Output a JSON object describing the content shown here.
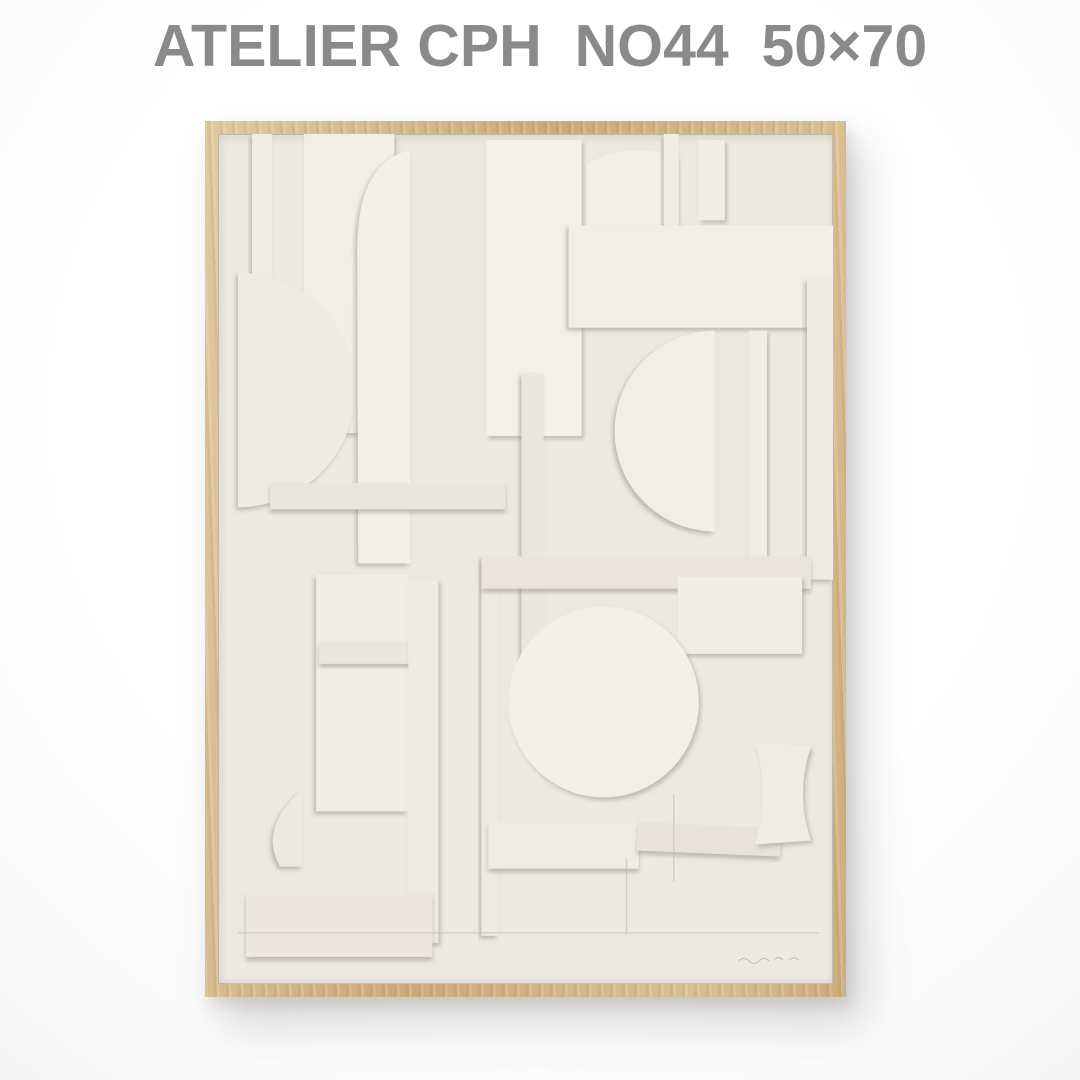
{
  "header": {
    "title": "ATELIER CPH  NO44  50×70",
    "brand": "ATELIER CPH",
    "item_no": "NO44",
    "size": "50×70",
    "text_color": "#8a8a8a"
  },
  "poster": {
    "frame_wood_color": "#cfae7e",
    "paper_color": "#ECE9E2",
    "shadow_color": "#968f81",
    "artwork": {
      "type": "paper-relief-collage",
      "pieces": [
        {
          "kind": "rect",
          "x": 34,
          "y": 0,
          "w": 20,
          "h": 200,
          "fill": "#EFECE5",
          "sh": "l"
        },
        {
          "kind": "rect",
          "x": 86,
          "y": 0,
          "w": 90,
          "h": 298,
          "fill": "#F0EEE7",
          "sh": "r"
        },
        {
          "kind": "path",
          "d": "M20 138 A117 117 0 0 1 20 372 Z",
          "fill": "#EDEBE4",
          "sh": "l"
        },
        {
          "kind": "path",
          "d": "M192 16 Q138 28 139 118 L140 428 L192 428 Z",
          "fill": "#F1EFE8",
          "sh": "l"
        },
        {
          "kind": "rect",
          "x": 268,
          "y": 6,
          "w": 95,
          "h": 295,
          "fill": "#F2F0E9",
          "sh": "r"
        },
        {
          "kind": "rect",
          "x": 303,
          "y": 238,
          "w": 22,
          "h": 300,
          "fill": "#EAE7DF",
          "sh": "l"
        },
        {
          "kind": "path",
          "d": "M368 101 L368 30 Q412 6 458 23 L458 101 Z",
          "fill": "#F1EFE9",
          "sh": "r"
        },
        {
          "kind": "rect",
          "x": 445,
          "y": 0,
          "w": 15,
          "h": 176,
          "fill": "#EFEDE6",
          "sh": "l"
        },
        {
          "kind": "rect",
          "x": 480,
          "y": 6,
          "w": 26,
          "h": 80,
          "fill": "#EFEDE6",
          "sh": "r"
        },
        {
          "kind": "rect",
          "x": 350,
          "y": 91,
          "w": 268,
          "h": 102,
          "fill": "#F0EEE7",
          "sh": "l"
        },
        {
          "kind": "path",
          "d": "M496 196 A100 100 0 0 0 496 396 Z",
          "fill": "#F0EEE7",
          "sh": "l"
        },
        {
          "kind": "rect",
          "x": 530,
          "y": 196,
          "w": 18,
          "h": 230,
          "fill": "#EFECE5",
          "sh": "r"
        },
        {
          "kind": "rect",
          "x": 588,
          "y": 144,
          "w": 26,
          "h": 300,
          "fill": "#EEEBE4",
          "sh": "l"
        },
        {
          "kind": "rect",
          "x": 52,
          "y": 348,
          "w": 235,
          "h": 26,
          "fill": "#E9E6DD",
          "sh": "d"
        },
        {
          "kind": "rect",
          "x": 263,
          "y": 421,
          "w": 17,
          "h": 378,
          "fill": "#EDEAE2",
          "sh": "l"
        },
        {
          "kind": "rect",
          "x": 263,
          "y": 421,
          "w": 329,
          "h": 32,
          "fill": "#E9E5DA",
          "sh": "d"
        },
        {
          "kind": "rect",
          "x": 459,
          "y": 441,
          "w": 124,
          "h": 77,
          "fill": "#F0EDE6",
          "sh": "r"
        },
        {
          "kind": "circle",
          "cx": 385,
          "cy": 566,
          "r": 95,
          "fill": "#F1EFE8",
          "sh": "r"
        },
        {
          "kind": "rect",
          "x": 98,
          "y": 439,
          "w": 92,
          "h": 236,
          "fill": "#F0EDE6",
          "sh": "l"
        },
        {
          "kind": "rect",
          "x": 101,
          "y": 506,
          "w": 102,
          "h": 22,
          "fill": "#E9E6DD",
          "sh": "d"
        },
        {
          "kind": "rect",
          "x": 190,
          "y": 444,
          "w": 30,
          "h": 362,
          "fill": "#EEEBE4",
          "sh": "r"
        },
        {
          "kind": "path",
          "d": "M84 653 Q40 692 62 730 L84 730 Z",
          "fill": "#ECE9E2",
          "sh": "l"
        },
        {
          "kind": "rect",
          "x": 28,
          "y": 756,
          "w": 186,
          "h": 64,
          "fill": "#ECE8DF",
          "sh": "d"
        },
        {
          "kind": "rect",
          "x": 270,
          "y": 686,
          "w": 150,
          "h": 46,
          "fill": "#EFECE4",
          "sh": "d"
        },
        {
          "kind": "path",
          "d": "M420 686 L563 692 L561 720 L418 714 Z",
          "fill": "#E7E3D8",
          "sh": "d"
        },
        {
          "kind": "path",
          "d": "M536 606 L592 610 Q576 658 592 704 L536 708 Q552 657 536 606 Z",
          "fill": "#EFECE5",
          "sh": "r"
        }
      ],
      "faint_lines": [
        {
          "x1": 20,
          "y1": 796,
          "x2": 600,
          "y2": 796
        },
        {
          "x1": 408,
          "y1": 722,
          "x2": 408,
          "y2": 798
        },
        {
          "x1": 455,
          "y1": 658,
          "x2": 455,
          "y2": 745
        }
      ],
      "signature_path": "M520 824 q5 -5 10 0 t10 0 t10 0 M556 822 q4 -3 8 1 M570 823 q5 -4 10 0",
      "signature_color": "#948d80"
    }
  }
}
